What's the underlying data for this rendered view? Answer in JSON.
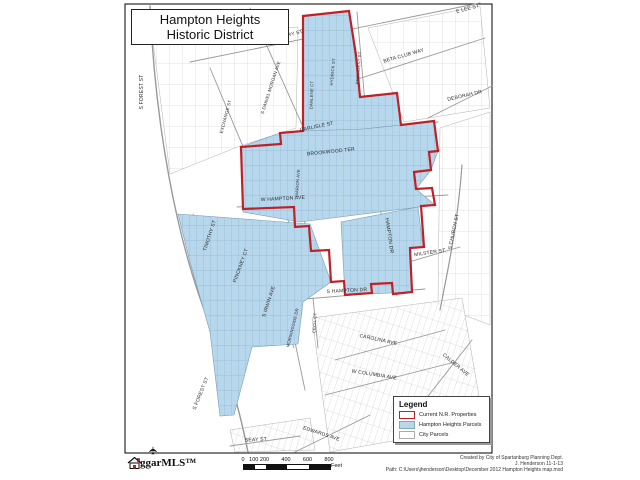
{
  "title": {
    "line1": "Hampton Heights",
    "line2": "Historic District"
  },
  "legend": {
    "title": "Legend",
    "items": [
      {
        "key": "nr",
        "label": "Current N.R. Properties"
      },
      {
        "key": "hh",
        "label": "Hampton Heights Parcels"
      },
      {
        "key": "city",
        "label": "City Parcels"
      }
    ]
  },
  "scalebar": {
    "ticks": [
      "0",
      "100",
      "200",
      "400",
      "600",
      "800"
    ],
    "unit": "Feet"
  },
  "logo": {
    "text": "ggarMLS™",
    "plane_icon": "✈"
  },
  "credits": {
    "lines": [
      "Created by City of Spartanburg Planning Dept.",
      "J. Henderson 11-1-13",
      "Path: C:\\Users\\jhenderson\\Desktop\\December 2012 Hampton Heights map.mxd"
    ]
  },
  "colors": {
    "district_fill": "#b7d7ec",
    "district_lotline": "#84a9c4",
    "nr_boundary": "#bf2126",
    "street_line": "#999999",
    "frame_border": "#000000"
  },
  "map": {
    "streets": [
      {
        "t": "W HENRY ST",
        "x": 287,
        "y": 37,
        "r": -15,
        "s": 5
      },
      {
        "t": "E LEE ST",
        "x": 468,
        "y": 10,
        "r": -15,
        "s": 5
      },
      {
        "t": "BETA CLUB WAY",
        "x": 404,
        "y": 57,
        "r": -16,
        "s": 5
      },
      {
        "t": "DEBORAH DR",
        "x": 465,
        "y": 97,
        "r": -13,
        "s": 5
      },
      {
        "t": "S DANIEL MORGAN AVE",
        "x": 272,
        "y": 88,
        "r": -72,
        "s": 4.5
      },
      {
        "t": "S FOREST ST",
        "x": 143,
        "y": 92,
        "r": -90,
        "s": 5
      },
      {
        "t": "EXCHANGE ST",
        "x": 227,
        "y": 117,
        "r": -75,
        "s": 4.5
      },
      {
        "t": "DARLENE CT",
        "x": 313,
        "y": 95,
        "r": -88,
        "s": 4.2
      },
      {
        "t": "HYDRICK ST",
        "x": 334,
        "y": 72,
        "r": -85,
        "s": 4.2
      },
      {
        "t": "PRESIDENT ST",
        "x": 360,
        "y": 68,
        "r": -85,
        "s": 4.2
      },
      {
        "t": "CARLISLE ST",
        "x": 317,
        "y": 128,
        "r": -12,
        "s": 5
      },
      {
        "t": "BROOKWOOD TER",
        "x": 331,
        "y": 153,
        "r": -6,
        "s": 5
      },
      {
        "t": "W HAMPTON AVE",
        "x": 283,
        "y": 200,
        "r": -3,
        "s": 5
      },
      {
        "t": "MARION AVE",
        "x": 299,
        "y": 183,
        "r": -86,
        "s": 4.2
      },
      {
        "t": "HAMPTON DR",
        "x": 388,
        "y": 236,
        "r": 82,
        "s": 5
      },
      {
        "t": "TIMOTHY ST",
        "x": 211,
        "y": 236,
        "r": -72,
        "s": 5
      },
      {
        "t": "PINCKNEY CT",
        "x": 242,
        "y": 266,
        "r": -70,
        "s": 5
      },
      {
        "t": "S IRWIN AVE",
        "x": 270,
        "y": 302,
        "r": -72,
        "s": 5
      },
      {
        "t": "MORNINGSIDE DR",
        "x": 294,
        "y": 328,
        "r": -76,
        "s": 4.2
      },
      {
        "t": "CECIL CT",
        "x": 316,
        "y": 323,
        "r": -86,
        "s": 4.2
      },
      {
        "t": "S HAMPTON DR",
        "x": 347,
        "y": 292,
        "r": -3,
        "s": 5
      },
      {
        "t": "CAROLINA AVE",
        "x": 378,
        "y": 341,
        "r": 12,
        "s": 5
      },
      {
        "t": "W COLUMBIA AVE",
        "x": 374,
        "y": 376,
        "r": 9,
        "s": 5
      },
      {
        "t": "CALDER AVE",
        "x": 455,
        "y": 366,
        "r": 40,
        "s": 5
      },
      {
        "t": "MILSTER ST",
        "x": 430,
        "y": 254,
        "r": -8,
        "s": 5
      },
      {
        "t": "S CHURCH ST",
        "x": 455,
        "y": 232,
        "r": -78,
        "s": 5
      },
      {
        "t": "S FOREST ST",
        "x": 202,
        "y": 394,
        "r": -68,
        "s": 5
      },
      {
        "t": "SEAY ST",
        "x": 256,
        "y": 441,
        "r": -3,
        "s": 5
      },
      {
        "t": "EDWARDS AVE",
        "x": 321,
        "y": 435,
        "r": 18,
        "s": 5
      }
    ]
  }
}
